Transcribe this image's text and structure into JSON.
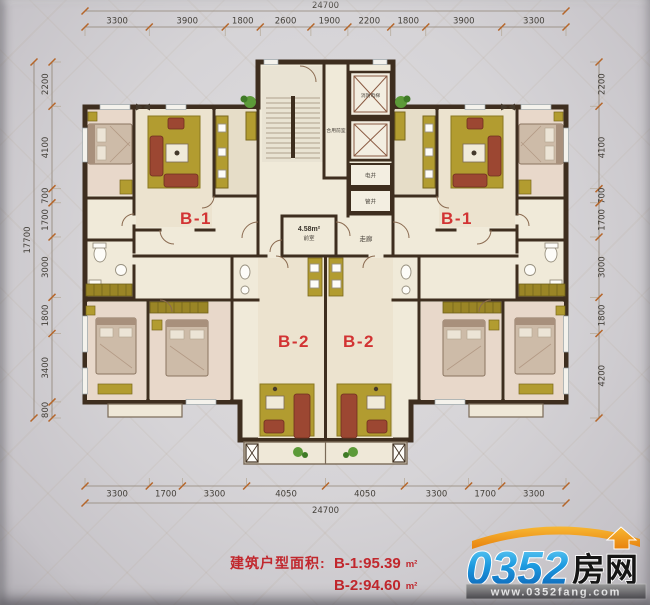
{
  "dimensions": {
    "top": {
      "total": "24700",
      "segments": [
        "3300",
        "3900",
        "1800",
        "2600",
        "1900",
        "2200",
        "1800",
        "3900",
        "3300"
      ]
    },
    "bottom": {
      "total": "24700",
      "segments": [
        "3300",
        "1700",
        "3300",
        "4050",
        "4050",
        "3300",
        "1700",
        "3300"
      ]
    },
    "left": {
      "total": "17700",
      "segments": [
        "2200",
        "4100",
        "700",
        "1700",
        "3000",
        "1800",
        "3400",
        "800"
      ]
    },
    "right": {
      "segments": [
        "2200",
        "4100",
        "700",
        "1700",
        "3000",
        "1800",
        "4200"
      ]
    }
  },
  "units": {
    "b1_left": "B-1",
    "b1_right": "B-1",
    "b2_left": "B-2",
    "b2_right": "B-2"
  },
  "core": {
    "fire_elevator": "消防电梯",
    "shared_vestibule": "合用前室",
    "electric_shaft": "电井",
    "pipe_shaft": "管井",
    "corridor": "走廊",
    "vestibule_area": "4.58m²",
    "vestibule": "前室"
  },
  "footer": {
    "caption": "建筑户型面积:",
    "b1_area": "B-1:95.39",
    "b2_area": "B-2:94.60",
    "unit": "m²"
  },
  "logo": {
    "number": "0352",
    "name": "房网",
    "url": "www.0352fang.com"
  },
  "colors": {
    "wall": "#3e2e1f",
    "floor": "#f0ead9",
    "olive": "#b29c30",
    "olive_dark": "#7a681c",
    "sofa_red": "#9c4732",
    "label_red": "#d23333",
    "footer_red": "#c1272d",
    "logo_blue_light": "#6fd4f8",
    "logo_blue_dark": "#0b5bb0",
    "logo_orange": "#f49b1b",
    "url_bar_gray": "#6e6c6d"
  }
}
